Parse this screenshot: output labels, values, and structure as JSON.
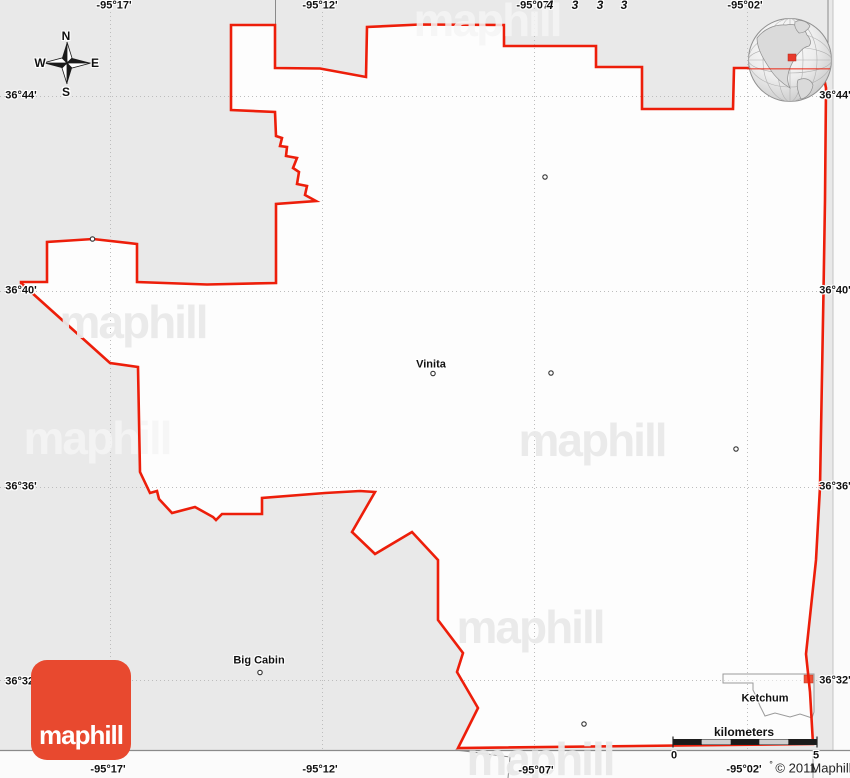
{
  "grid": {
    "top_labels": [
      "-95°17'",
      "-95°12'",
      "-95°07'",
      "-95°02'"
    ],
    "bottom_labels": [
      "-95°17'",
      "-95°12'",
      "-95°07'",
      "-95°02'"
    ],
    "left_labels": [
      "36°44'",
      "36°40'",
      "36°36'",
      "36°32'"
    ],
    "right_labels": [
      "36°44'",
      "36°40'",
      "36°36'",
      "36°32'"
    ],
    "stray_digits": [
      "4",
      "3",
      "3",
      "3"
    ]
  },
  "compass": {
    "n": "N",
    "e": "E",
    "s": "S",
    "w": "W"
  },
  "towns": {
    "vinita": "Vinita",
    "big_cabin": "Big Cabin",
    "ketchum": "Ketchum"
  },
  "scalebar": {
    "unit_label": "kilometers",
    "min": "0",
    "max": "5"
  },
  "attribution": {
    "degree_mark": "°",
    "copyright": "© 2011",
    "brand": "Maphill"
  },
  "logo": {
    "text": "maphill"
  },
  "watermark": {
    "text": "maphill"
  },
  "colors": {
    "county_border": "#ed1e0a",
    "county_fill": "#fdfdfd",
    "map_background": "#e9e9e9",
    "logo_background": "#e8492f",
    "inset_marker": "#ef5036"
  }
}
